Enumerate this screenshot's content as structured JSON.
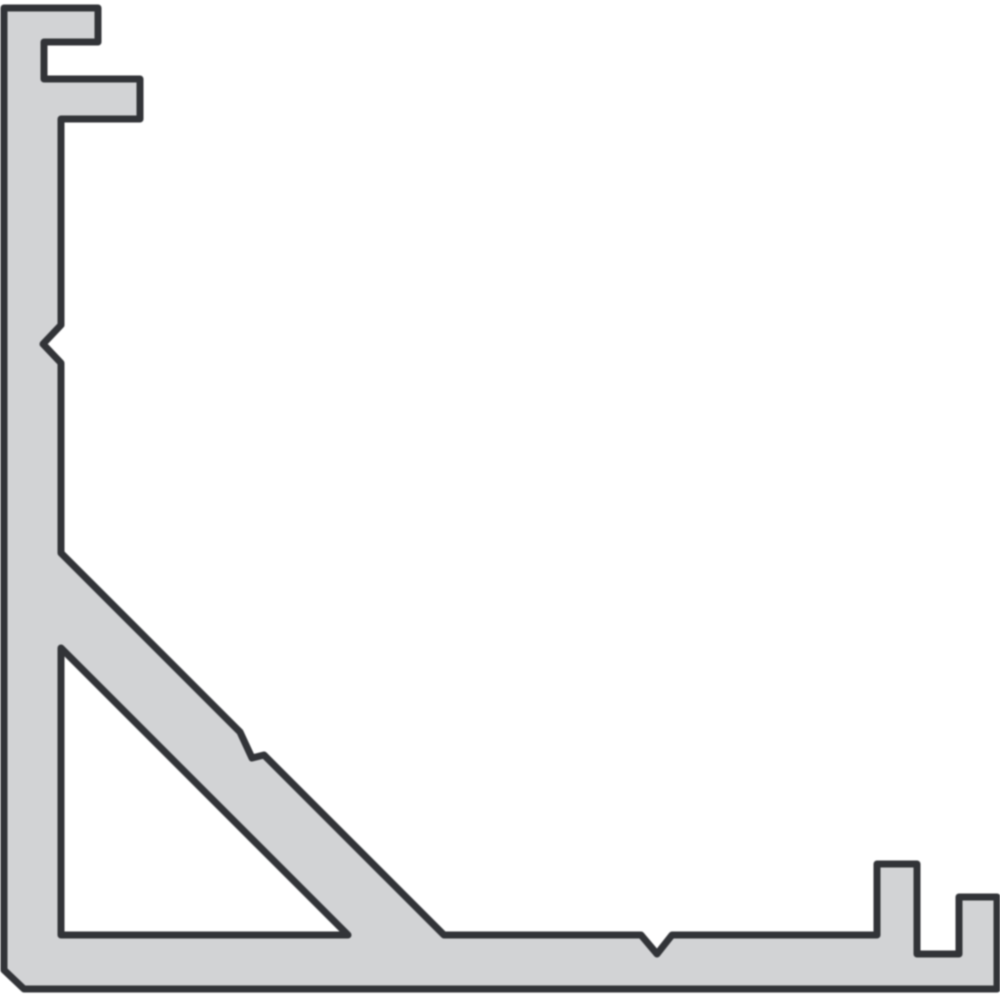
{
  "figure": {
    "name": "aluminum-corner-profile-cross-section",
    "canvas_width": 1000,
    "canvas_height": 1000,
    "background_color": "#ffffff",
    "shape_fill_color": "#d2d3d5",
    "outline_color": "#323438",
    "outline_width": 7,
    "outline_points": [
      [
        4,
        8
      ],
      [
        98,
        8
      ],
      [
        98,
        42
      ],
      [
        44,
        42
      ],
      [
        44,
        79
      ],
      [
        140,
        79
      ],
      [
        140,
        119
      ],
      [
        61,
        119
      ],
      [
        61,
        325
      ],
      [
        43,
        344
      ],
      [
        61,
        363
      ],
      [
        61,
        553
      ],
      [
        240,
        732
      ],
      [
        252,
        758
      ],
      [
        264,
        755
      ],
      [
        444,
        935
      ],
      [
        641,
        935
      ],
      [
        657,
        954
      ],
      [
        672,
        935
      ],
      [
        877,
        935
      ],
      [
        877,
        864
      ],
      [
        917,
        864
      ],
      [
        917,
        954
      ],
      [
        959,
        954
      ],
      [
        959,
        897
      ],
      [
        997,
        897
      ],
      [
        997,
        989
      ],
      [
        24,
        989
      ],
      [
        4,
        970
      ]
    ],
    "cutout_points": [
      [
        61,
        648
      ],
      [
        348,
        935
      ],
      [
        61,
        935
      ]
    ]
  }
}
